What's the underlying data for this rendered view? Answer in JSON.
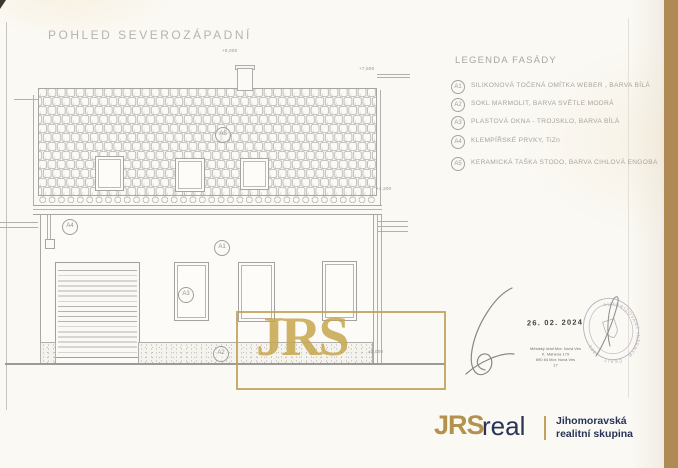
{
  "page": {
    "title": "POHLED SEVEROZÁPADNÍ"
  },
  "legend": {
    "title": "LEGENDA FASÁDY",
    "items": [
      {
        "code": "A1",
        "text": "SILIKONOVÁ TOČENÁ OMÍTKA WEBER , BARVA BÍLÁ"
      },
      {
        "code": "A2",
        "text": "SOKL MARMOLIT, BARVA SVĚTLE MODRÁ"
      },
      {
        "code": "A3",
        "text": "PLASTOVÁ OKNA - TROJSKLO, BARVA BÍLÁ"
      },
      {
        "code": "A4",
        "text": "KLEMPÍŘSKÉ PRVKY, TiZn"
      },
      {
        "code": "A5",
        "text": "KERAMICKÁ TAŠKA STODO, BARVA CIHLOVÁ ENGOBA"
      }
    ]
  },
  "drawing": {
    "elevations": {
      "chimney": "+8,000",
      "ridge": "+7,500",
      "eaves": "+4,200",
      "ground": "±0,000"
    }
  },
  "watermark": {
    "text": "JRS"
  },
  "approval": {
    "date": "26. 02. 2024",
    "office_lines": [
      "Městský úřad Mor. Nová Ves",
      "K. Mahena 179",
      "690 84 Mor. Nová Ves",
      "17"
    ],
    "seal_ring_text": "AUTORIZOVANÝ INŽENÝR · ČKAIT · 1300 ·"
  },
  "footer": {
    "brand_bold": "JRS",
    "brand_light": "real",
    "tagline_line1": "Jihomoravská",
    "tagline_line2": "realitní skupina"
  },
  "colors": {
    "gold": "#bb9a55",
    "navy": "#273456",
    "paper": "#fbf9f4",
    "wood": "#b08a55",
    "line_gray": "#adaca8"
  }
}
